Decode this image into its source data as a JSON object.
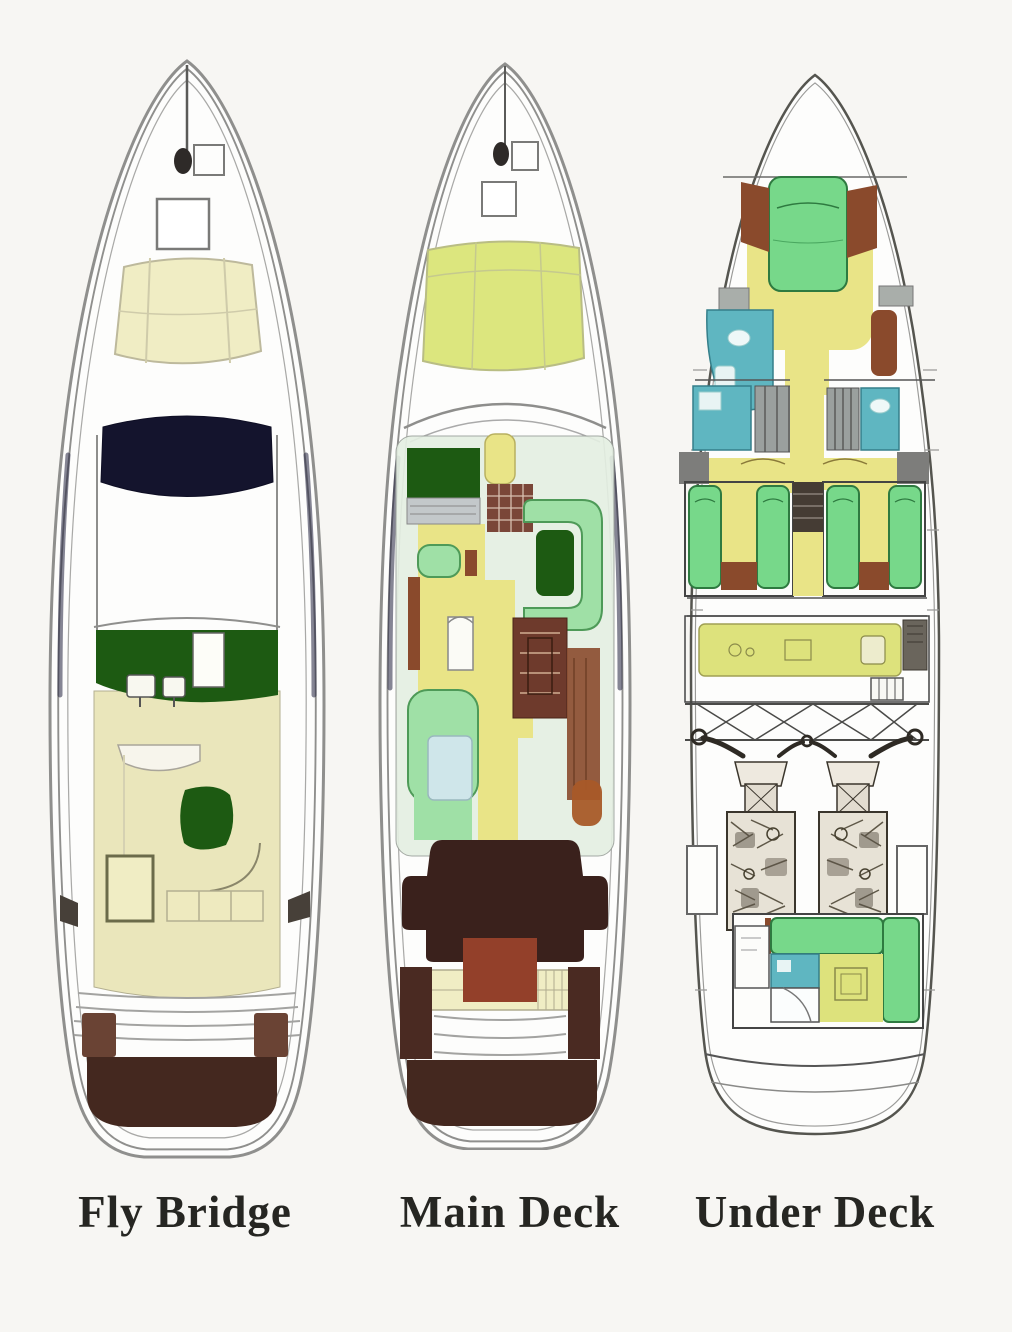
{
  "page": {
    "background": "#f7f6f3"
  },
  "decks": [
    {
      "id": "fly-bridge",
      "label": "Fly Bridge"
    },
    {
      "id": "main-deck",
      "label": "Main Deck"
    },
    {
      "id": "under-deck",
      "label": "Under Deck"
    }
  ],
  "palette": {
    "page_bg": "#f7f6f3",
    "ink": "#262622",
    "hull_fill": "#fdfdfc",
    "hull_line": "#8f8f8d",
    "hull_line_dark": "#55554f",
    "hull_shadow": "#23233e",
    "cream": "#f0edc4",
    "cream_deck": "#eae6bb",
    "navy": "#14142d",
    "dark_green": "#1d5a12",
    "mint": "#9fe0a6",
    "mint_line": "#4e9a58",
    "green_bed": "#77d88a",
    "green_bed_line": "#2e7a40",
    "yellow_floor": "#e9e487",
    "yellow_olive": "#dde27c",
    "sunpad_main": "#dce67e",
    "teal": "#5fb6c1",
    "teal_line": "#357f8a",
    "wood": "#8a4a2c",
    "maroon_stairs": "#7a4638",
    "dinette": "#6e3a2c",
    "cockpit_dark": "#3a211c",
    "platform": "#44281f",
    "gray_band": "#7d7d7b",
    "locker_gray": "#a9aeaa",
    "closet_gray": "#9aa09e",
    "table_red": "#93402a",
    "orange_brown": "#a85a28",
    "pale_blue": "#cfe6ea",
    "saloon_bg": "#e4efe2",
    "stairs_dark": "#453c34",
    "engine_fill": "#e7e2d6",
    "engine_line": "#3a352c"
  }
}
